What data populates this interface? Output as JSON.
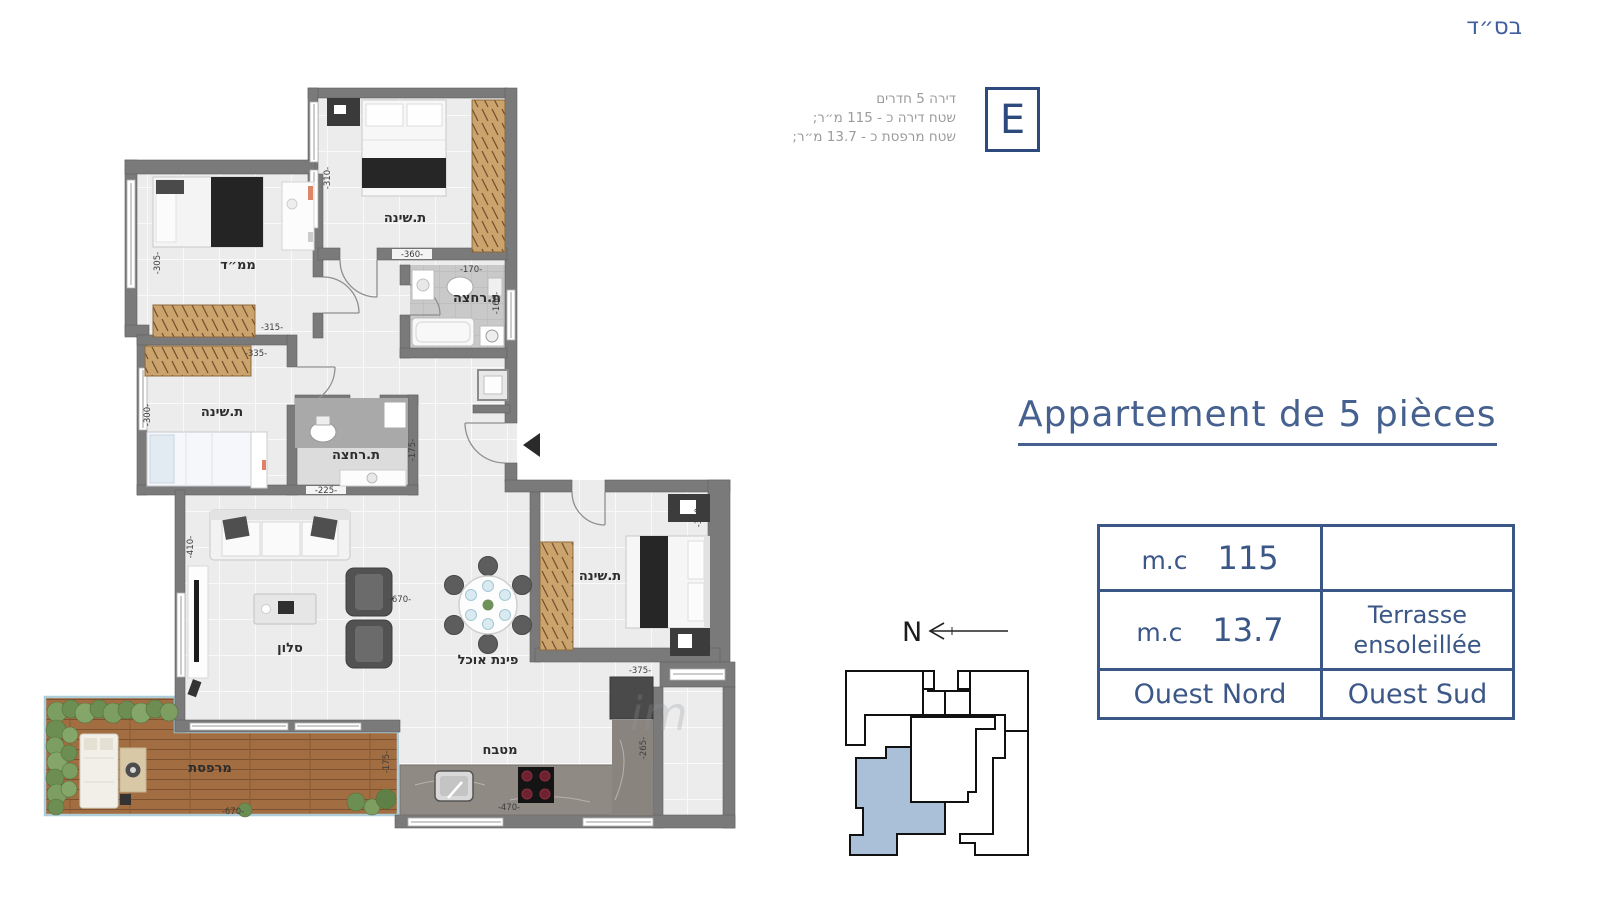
{
  "page": {
    "background": "#ffffff"
  },
  "top_right_blessing": "בס״ד",
  "unit_info": {
    "letter": "E",
    "lines": [
      "דירה 5 חדרים",
      "שטח דירה כ - 115 מ״ר;",
      "שטח מרפסת כ - 13.7 מ״ר;"
    ]
  },
  "title": "Appartement de 5 pièces",
  "spec_table": {
    "rows": [
      {
        "unit": "m.c",
        "value": "115",
        "right": ""
      },
      {
        "unit": "m.c",
        "value": "13.7",
        "right_line1": "Terrasse",
        "right_line2": "ensoleillée"
      },
      {
        "left": "Ouest Nord",
        "right": "Ouest Sud"
      }
    ]
  },
  "compass": {
    "label": "N"
  },
  "watermark": "im",
  "floor_plan": {
    "rooms": [
      {
        "id": "bedroom-top",
        "label": "ת.שינה"
      },
      {
        "id": "safe-room",
        "label": "ממ״ד"
      },
      {
        "id": "bathroom-top",
        "label": "ת.רחצה"
      },
      {
        "id": "bedroom-left",
        "label": "ת.שינה"
      },
      {
        "id": "bathroom-middle",
        "label": "ת.רחצה"
      },
      {
        "id": "living-room",
        "label": "סלון"
      },
      {
        "id": "dining-area",
        "label": "פינת אוכל"
      },
      {
        "id": "bedroom-right",
        "label": "ת.שינה"
      },
      {
        "id": "kitchen",
        "label": "מטבח"
      },
      {
        "id": "terrace",
        "label": "מרפסת"
      }
    ],
    "dimensions": [
      {
        "t": "-310-"
      },
      {
        "t": "-360-"
      },
      {
        "t": "-170-"
      },
      {
        "t": "-160-"
      },
      {
        "t": "-305-"
      },
      {
        "t": "-315-"
      },
      {
        "t": "-335-"
      },
      {
        "t": "-300-"
      },
      {
        "t": "-175-"
      },
      {
        "t": "-225-"
      },
      {
        "t": "-410-"
      },
      {
        "t": "-670-"
      },
      {
        "t": "-340-"
      },
      {
        "t": "-375-"
      },
      {
        "t": "-265-"
      },
      {
        "t": "-470-"
      },
      {
        "t": "-175-"
      },
      {
        "t": "-670-"
      }
    ]
  },
  "colors": {
    "navy": "#3b5787",
    "title_blue": "#46618f",
    "info_gray": "#9b9b9b",
    "unit_highlight": "#a9c0d8",
    "wall_gray": "#7a7a7a"
  }
}
